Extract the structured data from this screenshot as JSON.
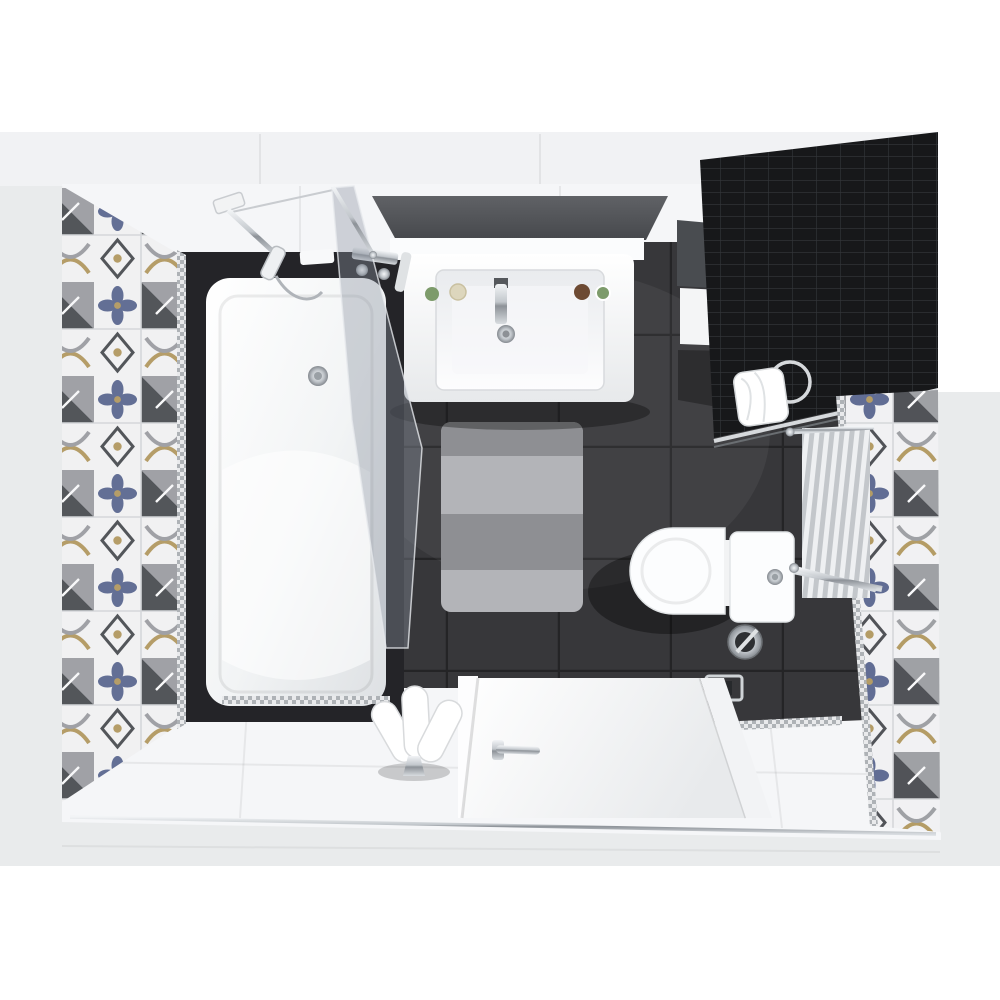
{
  "scene": {
    "title": "top-down-bathroom-render",
    "view": "overhead plan 3d render, no visible text",
    "objects": [
      {
        "name": "bathtub",
        "desc": "white tub in dark surround, top-left"
      },
      {
        "name": "shower-glass-screen",
        "desc": "tinted glass panel over tub"
      },
      {
        "name": "shower-arm",
        "desc": "chrome wall shower with hand set"
      },
      {
        "name": "vanity-sink",
        "desc": "white basin under dark gray counter, top-center"
      },
      {
        "name": "wall-cabinet",
        "desc": "dark gray cabinet with white front, top-right"
      },
      {
        "name": "black-mosaic-wall",
        "desc": "black tile grid wall, top-right corner"
      },
      {
        "name": "toilet",
        "desc": "white wc with chrome flush, right-center"
      },
      {
        "name": "towel-radiator",
        "desc": "vertical rails on right patterned wall"
      },
      {
        "name": "striped-rug",
        "desc": "gray striped bath mat on dark floor"
      },
      {
        "name": "patterned-tile-walls",
        "desc": "patchwork tiles left and right walls"
      },
      {
        "name": "open-door",
        "desc": "white door with chrome handle, bottom"
      },
      {
        "name": "floor-towel",
        "desc": "fan-folded white towel on chrome stand"
      },
      {
        "name": "wall-towel",
        "desc": "white towel on chrome ring, black wall"
      },
      {
        "name": "toilet-brush",
        "desc": "chrome brush holder on floor"
      },
      {
        "name": "paper-holder",
        "desc": "chrome roll holder on floor"
      }
    ]
  },
  "colors": {
    "page_bg": "#ffffff",
    "outer_wall": "#e9ebec",
    "top_band": "#f1f2f4",
    "wall_face": "#f5f6f8",
    "floor_dark": "#37373a",
    "floor_white": "#f5f6f8",
    "tub_surround": "#242428",
    "porcelain_white": "#fcfdfe",
    "counter_gray": "#55585c",
    "cabinet_gray": "#494c50",
    "cabinet_dark": "#323437",
    "wall_black": "#17181a",
    "mosaic_line": "#34373b",
    "chrome_light": "#e6e9ec",
    "chrome_mid": "#b9bec3",
    "chrome_dark": "#7e838a",
    "rug_dark": "#8e8f93",
    "rug_light": "#b3b4b8",
    "tile_white": "#f7f7f8",
    "tile_blue": "#56648e",
    "tile_gold": "#b3985a",
    "tile_gray": "#9b9da1",
    "tile_charcoal": "#44474b",
    "glass_tint": "rgba(140,148,160,0.38)",
    "towel_white": "#ffffff",
    "green_accent": "#7d9b6b",
    "cream_accent": "#ddd6bd",
    "brown_accent": "#6d4a33"
  }
}
